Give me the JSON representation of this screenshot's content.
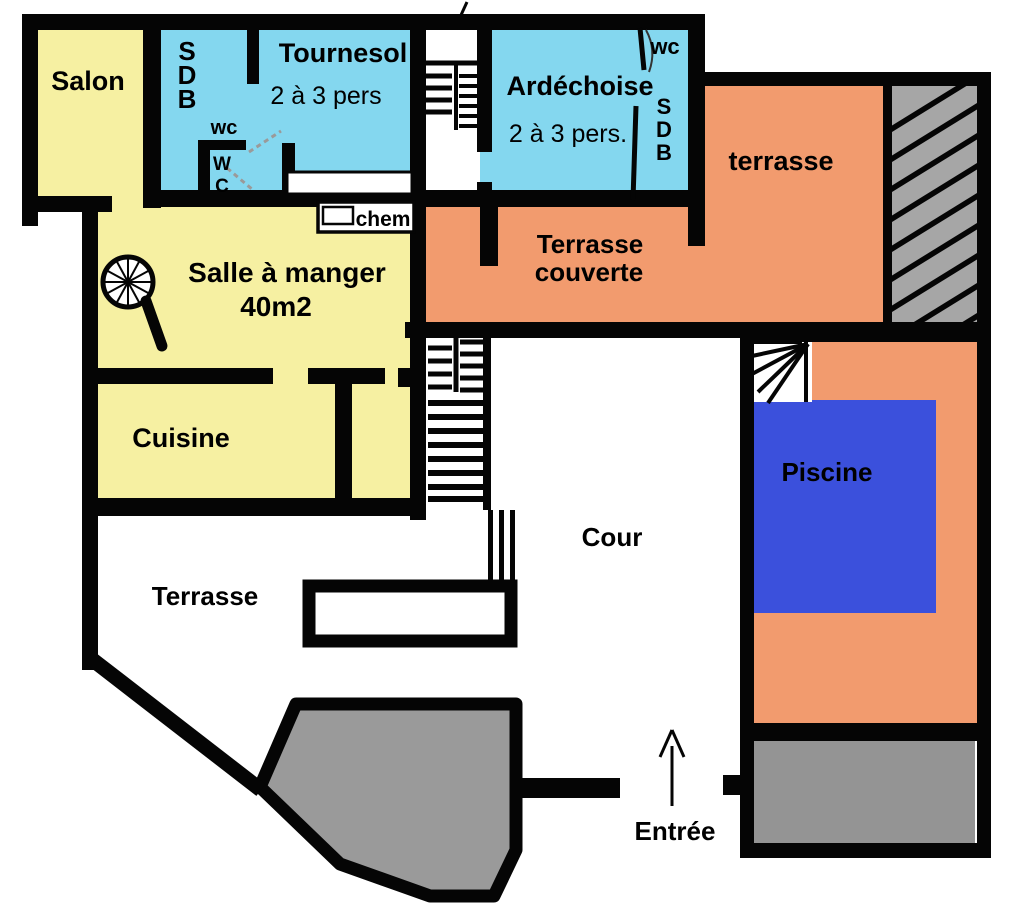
{
  "rooms": {
    "salon": {
      "label": "Salon"
    },
    "sdb_tournesol": {
      "letters": [
        "S",
        "D",
        "B"
      ]
    },
    "wc_tournesol": {
      "label": "wc",
      "closet_letters": [
        "W",
        "C"
      ]
    },
    "tournesol": {
      "name": "Tournesol",
      "capacity": "2 à 3 pers"
    },
    "ardechoise": {
      "name": "Ardéchoise",
      "capacity": "2 à 3 pers."
    },
    "wc_ardechoise": {
      "label": "wc"
    },
    "sdb_ardechoise": {
      "letters": [
        "S",
        "D",
        "B"
      ]
    },
    "terrasse_haute": {
      "label": "terrasse"
    },
    "terrasse_couverte": {
      "line1": "Terrasse",
      "line2": "couverte"
    },
    "salle_a_manger": {
      "name": "Salle à manger",
      "area": "40m2"
    },
    "cheminee": {
      "label": "chem"
    },
    "cuisine": {
      "label": "Cuisine"
    },
    "cour": {
      "label": "Cour"
    },
    "piscine": {
      "label": "Piscine"
    },
    "terrasse_basse": {
      "label": "Terrasse"
    },
    "entree": {
      "label": "Entrée"
    }
  },
  "colors": {
    "room_yellow": "#f6f0a2",
    "room_blue": "#84d7ef",
    "terrace_orange": "#f29b6e",
    "pool_blue": "#3b50dc",
    "paving_gray": "#9a9a9a",
    "hatch_gray": "#a6a6a6",
    "garage_gray": "#949494",
    "wall_black": "#050505",
    "white": "#ffffff"
  }
}
